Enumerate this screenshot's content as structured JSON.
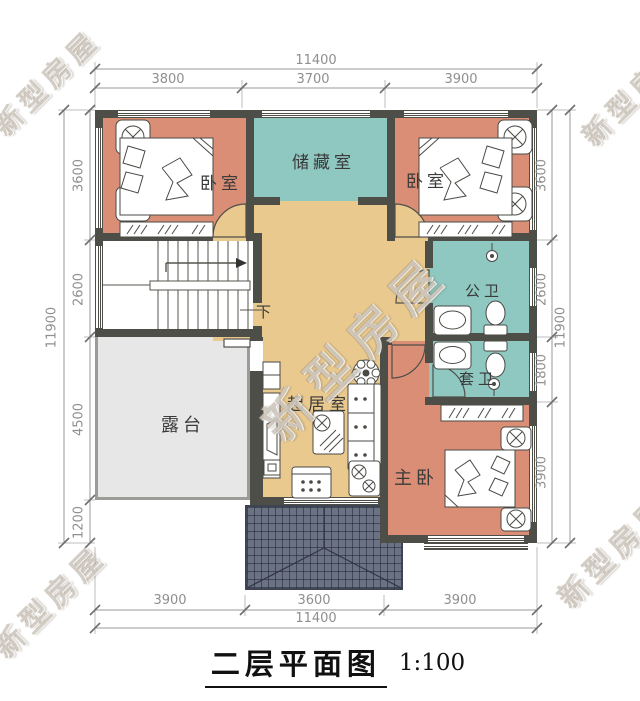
{
  "title": {
    "text": "二层平面图",
    "scale": "1:100"
  },
  "watermark": {
    "text": "新型房屋"
  },
  "rooms": {
    "bedroom_left": "卧室",
    "storage": "储藏室",
    "bedroom_right": "卧室",
    "public_bath": "公卫",
    "ensuite_bath": "套卫",
    "living": "起居室",
    "terrace": "露台",
    "master": "主卧",
    "stairs_down": "下"
  },
  "dimensions": {
    "top": {
      "total": "11400",
      "segments": [
        "3800",
        "3700",
        "3900"
      ]
    },
    "bottom": {
      "total": "11400",
      "segments": [
        "3900",
        "3600",
        "3900"
      ]
    },
    "left": {
      "total": "11900",
      "segments": [
        "3600",
        "2600",
        "4500",
        "1200"
      ]
    },
    "right": {
      "total": "11900",
      "segments": [
        "3600",
        "2600",
        "1800",
        "3900"
      ]
    }
  },
  "colors": {
    "bedroom": "#d98e75",
    "bathroom": "#8fc7c1",
    "hall": "#e9c98e",
    "terrace": "#e7e7e7",
    "wall": "#4e4e49",
    "roof": "#6a7284"
  }
}
